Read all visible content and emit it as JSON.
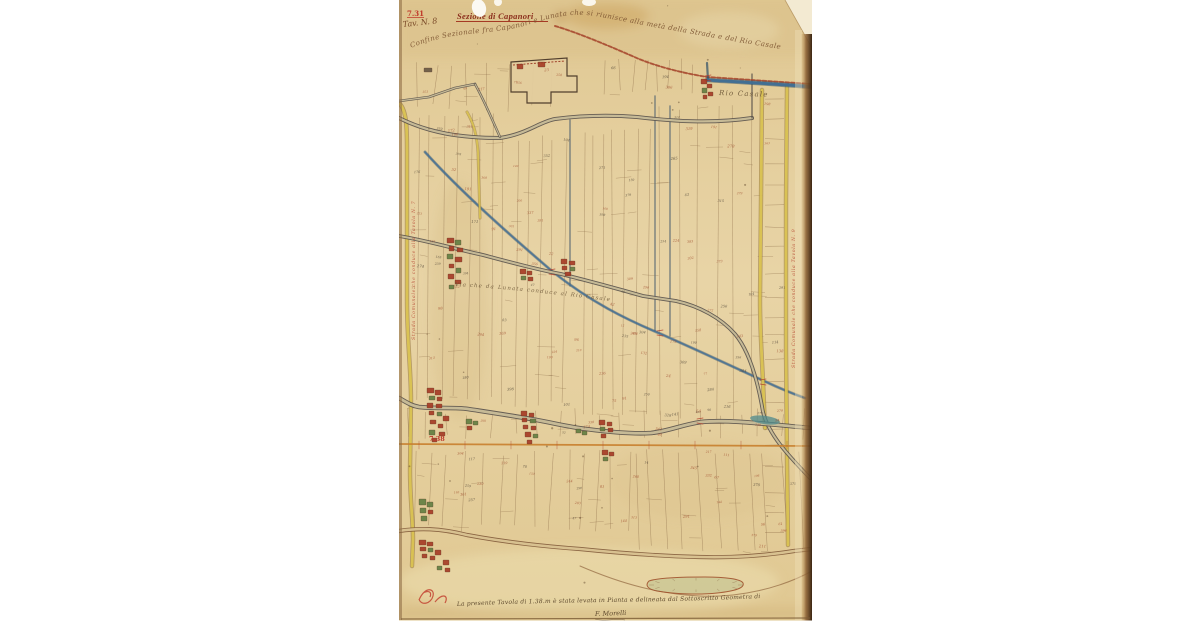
{
  "scan": {
    "title": "Sezione di Capanori",
    "page_ref_red": "7.31",
    "page_ref_script": "Tav. N. 8",
    "section_ref_red": "7.38",
    "boundary_annotation": "Confine Sezionale fra Capanori e Lunata che si riunisce alla metà della Strada e del Rio Casale",
    "stream_label": "Rio Casale",
    "road_annotation_mid": "Via che da Lunata conduce al Rio Casale",
    "left_margin_road_label": "Strada Comunale che conduce alla Tavola N. 7",
    "right_margin_road_label": "Strada Comunale che conduce alla Tavola N. 9",
    "caption_line": "La presente Tavola di 1.38.m è stata levata in Pianta e delineata dal Sottoscritto Geometra di prima classe",
    "signature": "F. Morelli",
    "colors": {
      "paper": "#e6d1a0",
      "paper_shadow": "#c9a96a",
      "ink_title": "#8b2e1c",
      "ink_script": "#7b5330",
      "ink_red": "#c0392b",
      "parcel_line": "#8a6a46",
      "number_red": "#9e4a2c",
      "number_dark": "#4a4034",
      "road_dark": "#57504a",
      "road_fill": "#c6ba96",
      "road_yellow": "#dcc553",
      "road_orange": "#c8802e",
      "road_red": "#a84a30",
      "water_blue": "#3e6e95",
      "water_edge": "#2e4e66",
      "building_red": "#a63c26",
      "building_green": "#637f43",
      "building_yellow": "#bfa03f",
      "bottom_road_brown": "#8a5e38"
    }
  }
}
